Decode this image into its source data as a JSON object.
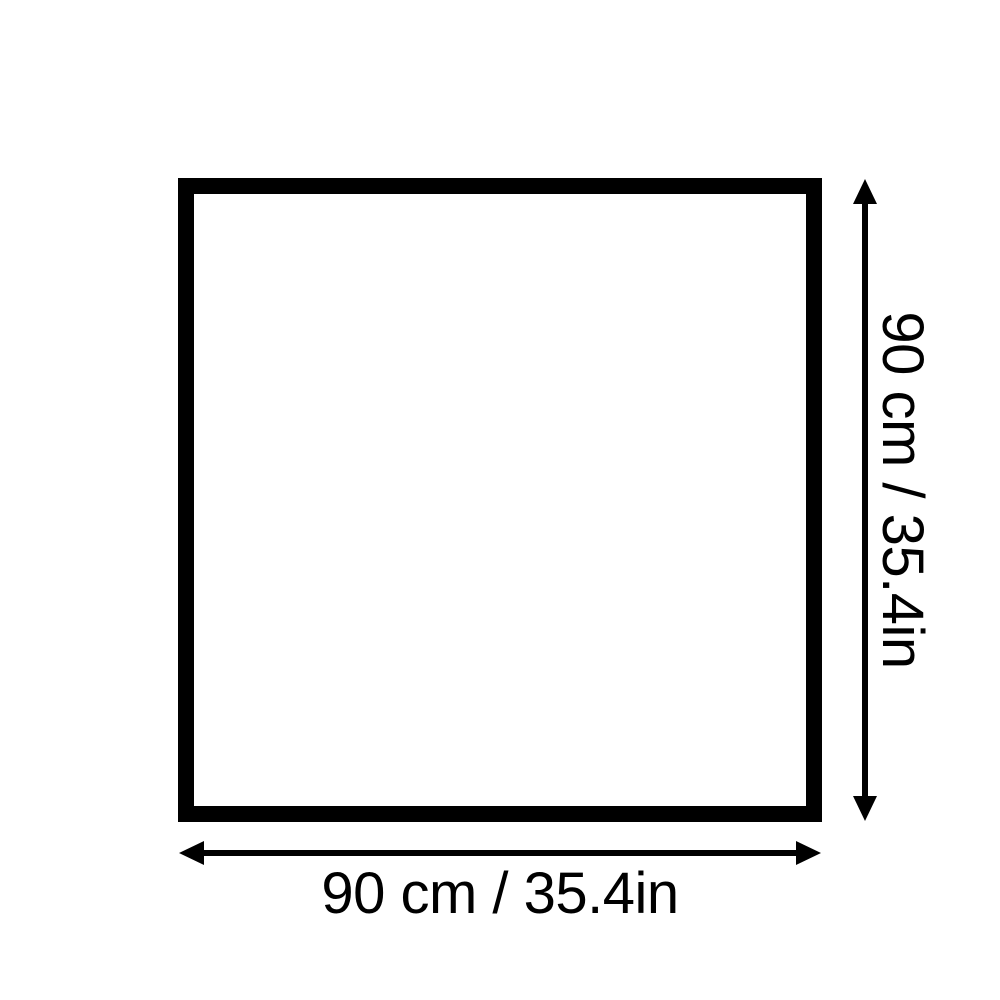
{
  "diagram": {
    "name": "product-dimensions-diagram",
    "width_dimension": {
      "label": "90 cm / 35.4in"
    },
    "height_dimension": {
      "label": "90 cm / 35.4in"
    },
    "colors": {
      "foreground": "#000000",
      "background": "#ffffff"
    }
  }
}
